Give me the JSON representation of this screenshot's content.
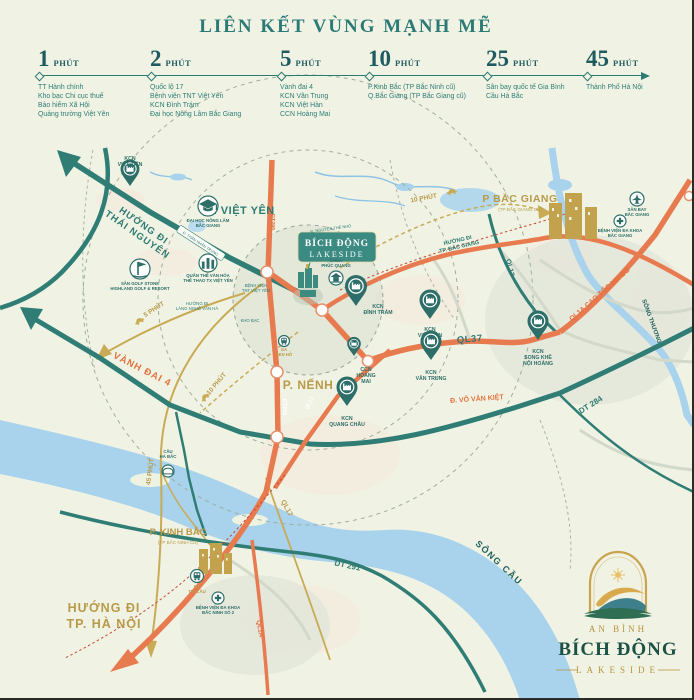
{
  "header": {
    "title": "LIÊN KẾT VÙNG MẠNH MẼ"
  },
  "timeline": [
    {
      "minutes": "1",
      "unit": "PHÚT",
      "items": [
        "TT Hành chính",
        "Kho bạc Chi cục thuế",
        "Bảo hiểm Xã Hội",
        "Quảng trường Việt Yên"
      ]
    },
    {
      "minutes": "2",
      "unit": "PHÚT",
      "items": [
        "Quốc lộ 17",
        "Bệnh viện TNT Việt Yên",
        "KCN Đình Trám",
        "Đại học Nông Lâm Bắc Giang"
      ]
    },
    {
      "minutes": "5",
      "unit": "PHÚT",
      "items": [
        "Vành đai 4",
        "KCN Vân Trung",
        "KCN Việt Hàn",
        "CCN Hoàng Mai"
      ]
    },
    {
      "minutes": "10",
      "unit": "PHÚT",
      "items": [
        "P.Kinh Bắc (TP Bắc Ninh cũ)",
        "Q.Bắc Giang (TP Bắc Giang cũ)"
      ]
    },
    {
      "minutes": "25",
      "unit": "PHÚT",
      "items": [
        "Sân bay quốc tế Gia Bình",
        "Cầu Hà Bắc"
      ]
    },
    {
      "minutes": "45",
      "unit": "PHÚT",
      "items": [
        "Thành Phố Hà Nội"
      ]
    }
  ],
  "colors": {
    "teal": "#2d7a72",
    "tealDark": "#1f5f5c",
    "gold": "#b99a4a",
    "orange": "#e2713f",
    "roadOrange": "#e87a4f",
    "roadTeal": "#2f7d74",
    "roadGold": "#c9aa55",
    "water": "#a9d2ec",
    "redDash": "#c24a37",
    "white": "#ffffff"
  },
  "map": {
    "project": {
      "name_line1": "BÍCH ĐỘNG",
      "name_line2": "LAKESIDE"
    },
    "street_badge": {
      "t": "Đ. THÂN NHÂN TRUNG",
      "x": 201,
      "y": 243,
      "r": 33
    },
    "labels": [
      {
        "t": "P. VIỆT YÊN",
        "x": 241,
        "y": 214,
        "c": "teal",
        "s": 11,
        "ls": 0.5
      },
      {
        "t": "P BẮC GIANG",
        "x": 520,
        "y": 202,
        "c": "gold",
        "s": 10.5,
        "ls": 0.5
      },
      {
        "t": "(TP BẮC GIANG CŨ)",
        "x": 520,
        "y": 211,
        "c": "gold",
        "s": 4.6,
        "w": "normal"
      },
      {
        "t": "P. KINH BẮC",
        "x": 178,
        "y": 535,
        "c": "gold",
        "s": 9.5
      },
      {
        "t": "(TP BẮC NINH CŨ)",
        "x": 178,
        "y": 544,
        "c": "gold",
        "s": 4.6,
        "w": "normal"
      },
      {
        "t": "P. NẾNH",
        "x": 308,
        "y": 389,
        "c": "gold",
        "s": 12,
        "ls": 0.5
      },
      {
        "lines": [
          "HƯỚNG ĐI",
          "THÁI NGUYÊN"
        ],
        "x": 142,
        "y": 228,
        "r": 35,
        "c": "teal",
        "s": 9.5,
        "lh": 11,
        "ls": 1
      },
      {
        "lines": [
          "HƯỚNG ĐI",
          "TP. HÀ NỘI"
        ],
        "x": 104,
        "y": 612,
        "c": "gold",
        "s": 12.5,
        "lh": 16,
        "ls": 1
      },
      {
        "lines": [
          "HƯỚNG ĐI",
          "TP. BẮC GIANG"
        ],
        "x": 458,
        "y": 242,
        "r": -13,
        "c": "teal",
        "s": 5.5,
        "lh": 6.5
      },
      {
        "lines": [
          "HƯỚNG ĐI",
          "LÀNG NGHỀ VÂN HÀ"
        ],
        "x": 197,
        "y": 305,
        "c": "teal",
        "s": 4.3,
        "lh": 5,
        "w": "normal"
      },
      {
        "t": "VÀNH ĐAI 4",
        "x": 141,
        "y": 372,
        "r": 27,
        "c": "orange",
        "s": 9.5,
        "ls": 1
      },
      {
        "t": "QL37",
        "x": 470,
        "y": 342,
        "r": -5,
        "c": "teal",
        "s": 9.5,
        "ls": 0.5
      },
      {
        "t": "Đ. VÕ VĂN KIỆT",
        "x": 477,
        "y": 401,
        "r": -4,
        "c": "orange",
        "s": 7
      },
      {
        "t": "DT 284",
        "x": 592,
        "y": 407,
        "r": -32,
        "c": "teal",
        "s": 8
      },
      {
        "t": "DT 291",
        "x": 347,
        "y": 568,
        "r": 12,
        "c": "teal",
        "s": 8
      },
      {
        "t": "QL17",
        "x": 508,
        "y": 268,
        "r": 77,
        "c": "teal",
        "s": 7
      },
      {
        "t": "QL17",
        "x": 285,
        "y": 509,
        "r": 62,
        "c": "gold",
        "s": 7
      },
      {
        "t": "QL1A",
        "x": 258,
        "y": 629,
        "r": 80,
        "c": "orange",
        "s": 6.5
      },
      {
        "t": "QL1A CAO TỐC HN-BG",
        "x": 601,
        "y": 296,
        "r": -41,
        "c": "orange",
        "s": 7
      },
      {
        "t": "ĐT295",
        "x": 271,
        "y": 222,
        "r": 90,
        "c": "orange",
        "s": 5.5
      },
      {
        "t": "ĐT295",
        "x": 283,
        "y": 407,
        "r": 90,
        "c": "white",
        "s": 5.5
      },
      {
        "t": "QL17",
        "x": 311,
        "y": 404,
        "r": -57,
        "c": "white",
        "s": 5.5
      },
      {
        "t": "SÔNG CẦU",
        "x": 497,
        "y": 565,
        "r": 43,
        "c": "tealDark",
        "s": 9,
        "ls": 1.5
      },
      {
        "t": "SÔNG THƯƠNG",
        "x": 650,
        "y": 322,
        "r": 70,
        "c": "tealDark",
        "s": 6
      },
      {
        "t": "Đ. NGUYỄN THẾ NHO",
        "x": 331,
        "y": 230,
        "r": -8,
        "c": "teal",
        "s": 4,
        "w": "normal"
      },
      {
        "t": "5 PHÚT",
        "x": 155,
        "y": 311,
        "r": -33,
        "c": "gold",
        "s": 6.5
      },
      {
        "t": "10 PHÚT",
        "x": 218,
        "y": 385,
        "r": -50,
        "c": "gold",
        "s": 6.5
      },
      {
        "t": "10 PHÚT",
        "x": 424,
        "y": 200,
        "r": -11,
        "c": "gold",
        "s": 6.5
      },
      {
        "t": "45 PHÚT",
        "x": 152,
        "y": 472,
        "r": -82,
        "c": "gold",
        "s": 6.5
      },
      {
        "lines": [
          "BỆNH VIỆN",
          "TNT VIỆT YÊN"
        ],
        "x": 256,
        "y": 287,
        "c": "teal",
        "s": 4.2,
        "lh": 5,
        "w": "normal"
      },
      {
        "t": "KHO BẠC",
        "x": 250,
        "y": 322,
        "c": "teal",
        "s": 4.2,
        "w": "normal"
      }
    ],
    "pins": [
      {
        "x": 130,
        "y": 186,
        "sc": 0.9,
        "lines": [
          "KCN",
          "VIỆT TIẾN"
        ],
        "ly": 160
      },
      {
        "x": 356,
        "y": 306,
        "sc": 1.05,
        "lines": [
          "KCN",
          "ĐÌNH TRÁM"
        ],
        "lx": 378,
        "ly": 308
      },
      {
        "x": 430,
        "y": 319,
        "sc": 1.0,
        "lines": [
          "KCN",
          "VIỆT HÀN"
        ],
        "ly": 331
      },
      {
        "x": 431,
        "y": 360,
        "sc": 1.0,
        "lines": [
          "KCN",
          "VÂN TRUNG"
        ],
        "ly": 374
      },
      {
        "x": 538,
        "y": 340,
        "sc": 1.0,
        "lines": [
          "KCN",
          "SONG KHÊ",
          "NỘI HOÀNG"
        ],
        "ly": 353
      },
      {
        "x": 347,
        "y": 406,
        "sc": 1.0,
        "lines": [
          "KCN",
          "QUANG CHÂU"
        ],
        "ly": 420
      },
      {
        "x": 354,
        "y": 356,
        "sc": 0.65,
        "lines": [
          "CCN",
          "HOÀNG",
          "MAI"
        ],
        "lx": 366,
        "ly": 371
      }
    ],
    "pois": [
      {
        "icon": "grad",
        "x": 208,
        "y": 206,
        "r": 10,
        "lines": [
          "ĐẠI HỌC NÔNG LÂM",
          "BẮC GIANG"
        ],
        "ly": 222
      },
      {
        "icon": "columns",
        "x": 208,
        "y": 263,
        "r": 9,
        "lines": [
          "QUẦN THỂ VĂN HÓA",
          "THỂ THAO TX VIỆT YÊN"
        ],
        "ly": 277
      },
      {
        "icon": "golf",
        "x": 140,
        "y": 269,
        "r": 10,
        "lines": [
          "SÂN GOLF STONE",
          "HIGHLAND GOLF & RESORT"
        ],
        "ly": 285
      },
      {
        "icon": "pagoda",
        "x": 336,
        "y": 278,
        "r": 7,
        "lines": [
          "CHÙA",
          "PHÚC QUANG"
        ],
        "ly": 262
      },
      {
        "icon": "plane",
        "x": 637,
        "y": 199,
        "r": 7,
        "lines": [
          "SÂN BAY",
          "BẮC GIANG"
        ],
        "ly": 211
      },
      {
        "icon": "cross",
        "x": 620,
        "y": 221,
        "r": 6,
        "lines": [
          "BỆNH VIỆN ĐA KHOA",
          "BẮC GIANG"
        ],
        "ly": 232
      },
      {
        "icon": "cross",
        "x": 218,
        "y": 598,
        "r": 6,
        "lines": [
          "BỆNH VIỆN ĐA KHOA",
          "BẮC NINH SỐ 2"
        ],
        "ly": 609
      },
      {
        "icon": "train",
        "x": 197,
        "y": 576,
        "r": 6.5,
        "lines": [
          "GA",
          "THỊ CẦU"
        ],
        "ly": 588,
        "lc": "gold"
      },
      {
        "icon": "train",
        "x": 284,
        "y": 341,
        "r": 5.5,
        "lines": [
          "GA",
          "SEN HỒ"
        ],
        "ly": 351,
        "lc": "gold"
      },
      {
        "icon": "bridge",
        "x": 168,
        "y": 471,
        "r": 6,
        "lines": [
          "CẦU",
          "HÀ BẮC"
        ],
        "ly": 453
      }
    ],
    "cars": [
      {
        "x": 140,
        "y": 322,
        "r": -33
      },
      {
        "x": 206,
        "y": 398,
        "r": -50
      },
      {
        "x": 452,
        "y": 193,
        "r": -12
      }
    ]
  },
  "logo": {
    "top": "AN BÌNH",
    "name": "BÍCH ĐỘNG",
    "bottom": "LAKESIDE"
  }
}
